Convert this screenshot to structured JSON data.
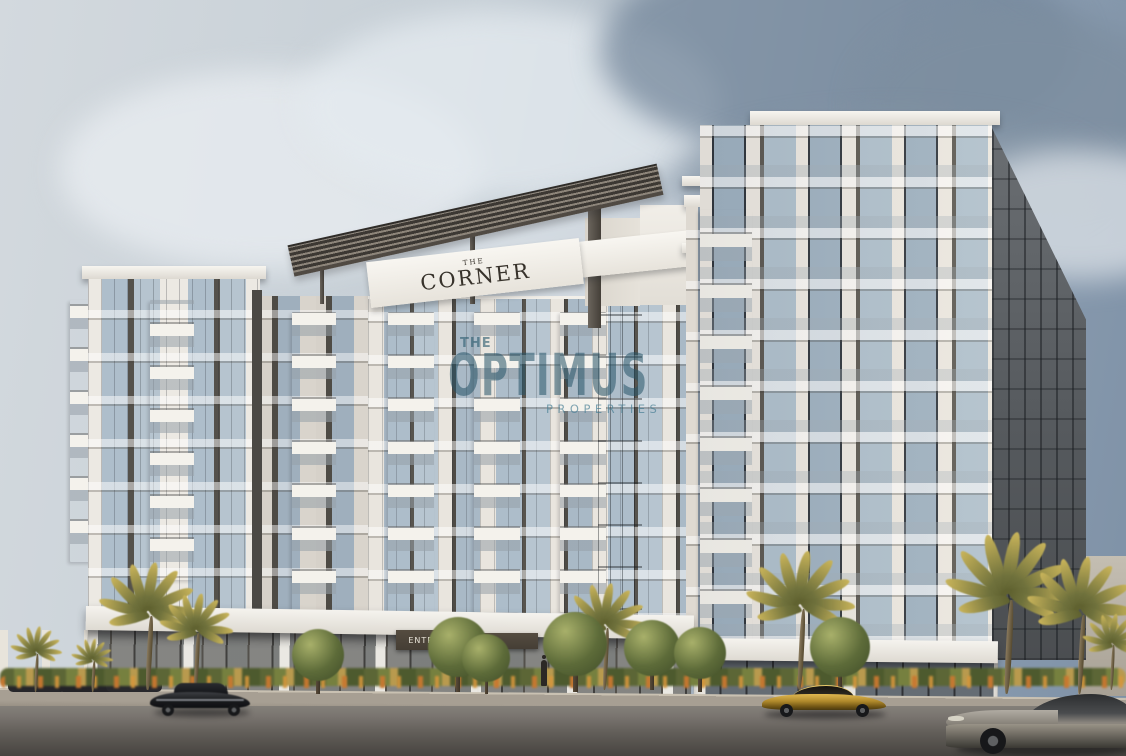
{
  "signs": {
    "building_name": {
      "prefix": "THE",
      "name": "CORNER"
    },
    "entrance": "ENTRANCE"
  },
  "watermark": {
    "prefix": "THE",
    "brand": "OPTIMUS",
    "tagline": "PROPERTIES"
  },
  "colors": {
    "sky_light": "#ccd3d9",
    "sky_dark": "#7e91a6",
    "building_white": "#efece6",
    "building_cream": "#ddd8d0",
    "facade_recess": "#54514b",
    "glass_light": "#aebecb",
    "glass_dark": "#5f6a76",
    "pergola_slat_dark": "#3c3833",
    "sign_bg": "#f6f4ef",
    "sign_text": "#37322b",
    "entrance_band": "#453e35",
    "entrance_text": "#e9e4d9",
    "side_wall": "#5a5e63",
    "podium_glass": "#77736c",
    "hedge_green": "#5c6636",
    "hedge_gold": "#b99a4e",
    "flower_orange": "#c97830",
    "palm_green": "#6f713c",
    "palm_gold": "#c9b45a",
    "tree_green": "#5d6b39",
    "sidewalk": "#a79f93",
    "road_light": "#7b7671",
    "road_dark": "#474440",
    "car_black": "#1a1b1e",
    "car_gold": "#b08a2c",
    "car_gray": "#938e87",
    "watermark_teal": "#2a5468"
  }
}
